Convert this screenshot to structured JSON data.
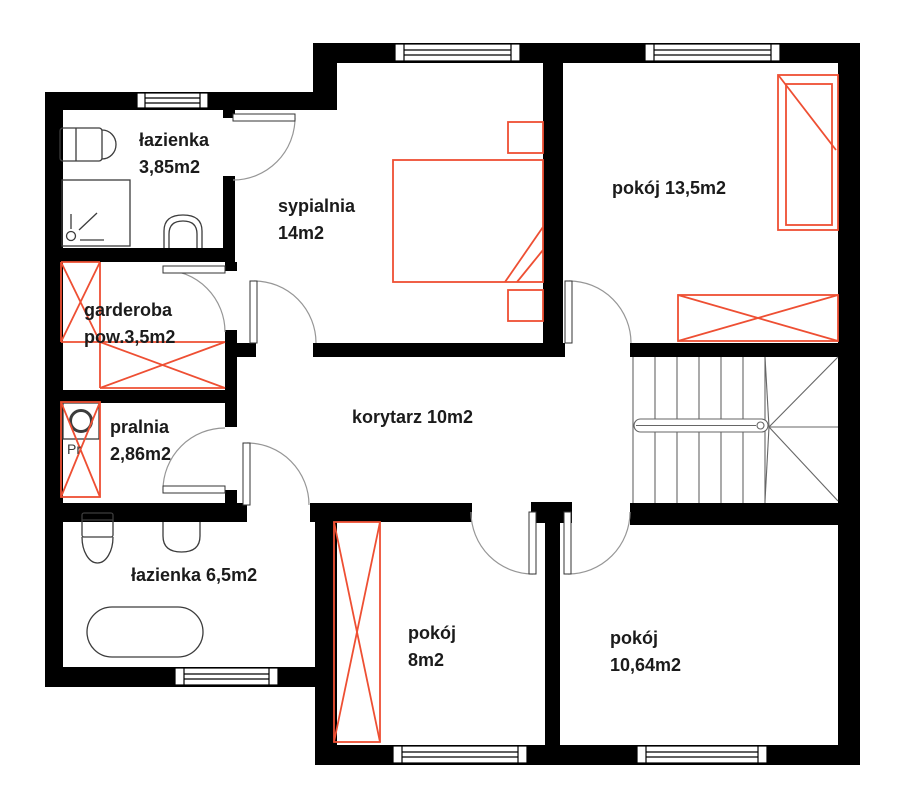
{
  "plan": {
    "rooms": [
      {
        "id": "lazienka-gorna",
        "label": "łazienka\n3,85m2"
      },
      {
        "id": "sypialnia",
        "label": "sypialnia\n14m2"
      },
      {
        "id": "pokoj-13-5",
        "label": "pokój 13,5m2"
      },
      {
        "id": "garderoba",
        "label": "garderoba\npow.3,5m2"
      },
      {
        "id": "pralnia",
        "label": "pralnia\n2,86m2"
      },
      {
        "id": "korytarz",
        "label": "korytarz 10m2"
      },
      {
        "id": "lazienka-dolna",
        "label": "łazienka 6,5m2"
      },
      {
        "id": "pokoj-8",
        "label": "pokój\n8m2"
      },
      {
        "id": "pokoj-10-64",
        "label": "pokój\n10,64m2"
      }
    ],
    "appliance_label": "Pr",
    "colors": {
      "wall": "#000000",
      "furniture": "#ee4f33",
      "fixture": "#3c3c3c",
      "door_arc": "#969696",
      "stairs": "#666666",
      "text": "#1b1b1b"
    }
  }
}
